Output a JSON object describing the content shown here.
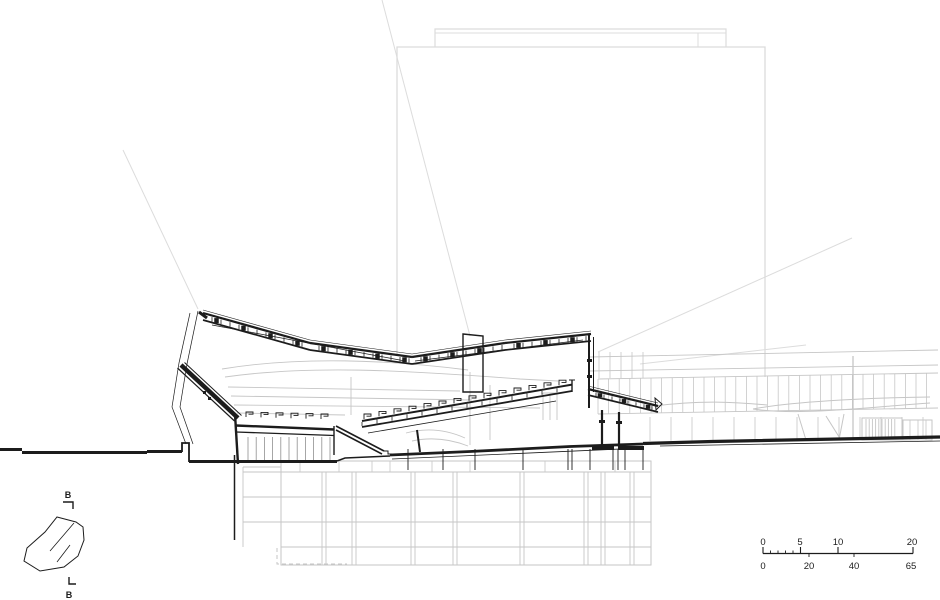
{
  "key_plan": {
    "section_marker_top": "B",
    "section_marker_bottom": "B"
  },
  "scale_bar": {
    "top_labels": [
      "0",
      "5",
      "10",
      "20"
    ],
    "bottom_labels": [
      "0",
      "20",
      "40",
      "65"
    ]
  },
  "colors": {
    "line_dark": "#1c1c1c",
    "line_mid": "#8f8f8f",
    "line_light_gray": "#dcdcdc",
    "line_gray": "#c6c6c6",
    "background": "#ffffff"
  }
}
